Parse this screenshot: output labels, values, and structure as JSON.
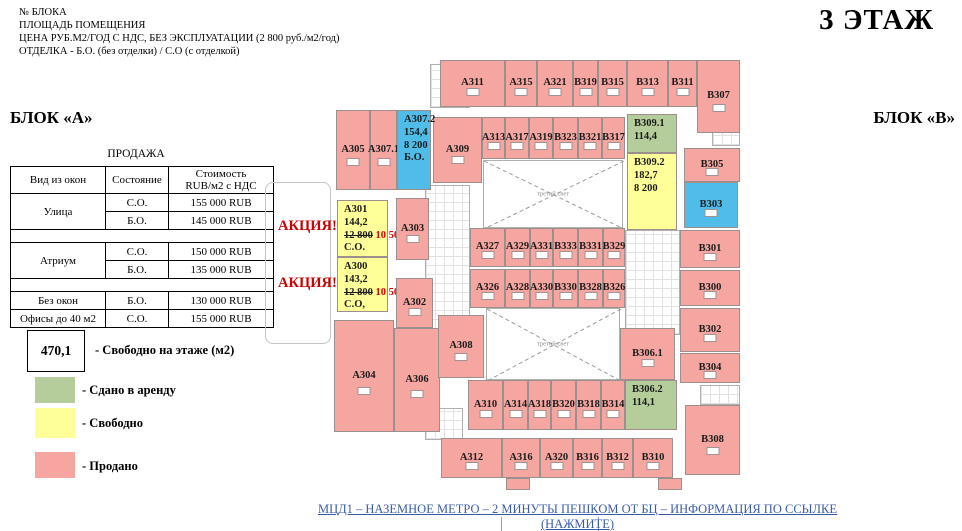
{
  "header": {
    "info_lines": [
      "№ БЛОКА",
      "ПЛОЩАДЬ ПОМЕЩЕНИЯ",
      "ЦЕНА РУБ.М2/ГОД С НДС, БЕЗ ЭКСПЛУАТАЦИИ (2 800 руб./м2/год)",
      "ОТДЕЛКА - Б.О. (без отделки) / С.О (с отделкой)"
    ],
    "floor_title": "3 ЭТАЖ",
    "block_a": "БЛОК «А»",
    "block_b": "БЛОК «В»"
  },
  "sales_table": {
    "title": "ПРОДАЖА",
    "col_view": "Вид из окон",
    "col_state": "Состояние",
    "col_price_1": "Стоимость",
    "col_price_2": "RUB/м2 с НДС",
    "street": "Улица",
    "atrium": "Атриум",
    "no_windows": "Без окон",
    "small_offices": "Офисы до 40 м2",
    "so": "С.О.",
    "bo": "Б.О.",
    "street_so_price": "155 000 RUB",
    "street_bo_price": "145 000 RUB",
    "atrium_so_price": "150 000 RUB",
    "atrium_bo_price": "135 000 RUB",
    "no_windows_price": "130 000 RUB",
    "small_offices_price": "155 000 RUB"
  },
  "legend": {
    "free_area_value": "470,1",
    "free_area_label": "- Свободно на этаже (м2)",
    "leased_label": "- Сдано в аренду",
    "free_label": "- Свободно",
    "sold_label": "- Продано"
  },
  "promo": {
    "label": "АКЦИЯ!"
  },
  "footer": {
    "link_text": "МЦД1 – НАЗЕМНОЕ МЕТРО – 2 МИНУТЫ ПЕШКОМ ОТ БЦ – ИНФОРМАЦИЯ ПО ССЫЛКЕ (НАЖМИТЕ)"
  },
  "floorplan": {
    "atrium_label": "третий свет",
    "status_colors": {
      "sold": "#f5a6a1",
      "leased": "#b5cd9b",
      "free": "#ffff99",
      "highlight": "#4fbde8",
      "promo_text": "#ce0000",
      "link": "#3a5ca8"
    },
    "rooms": [
      {
        "id": "А311",
        "s": "sold",
        "x": 440,
        "y": 60,
        "w": 65,
        "h": 47
      },
      {
        "id": "А315",
        "s": "sold",
        "x": 505,
        "y": 60,
        "w": 32,
        "h": 47
      },
      {
        "id": "А321",
        "s": "sold",
        "x": 537,
        "y": 60,
        "w": 36,
        "h": 47
      },
      {
        "id": "В319",
        "s": "sold",
        "x": 573,
        "y": 60,
        "w": 25,
        "h": 47
      },
      {
        "id": "В315",
        "s": "sold",
        "x": 598,
        "y": 60,
        "w": 29,
        "h": 47
      },
      {
        "id": "В313",
        "s": "sold",
        "x": 627,
        "y": 60,
        "w": 41,
        "h": 47
      },
      {
        "id": "В311",
        "s": "sold",
        "x": 668,
        "y": 60,
        "w": 29,
        "h": 47
      },
      {
        "id": "В307",
        "s": "sold",
        "x": 697,
        "y": 60,
        "w": 43,
        "h": 73
      },
      {
        "id": "А309",
        "s": "sold",
        "x": 433,
        "y": 117,
        "w": 49,
        "h": 66
      },
      {
        "id": "А313",
        "s": "sold",
        "x": 482,
        "y": 117,
        "w": 23,
        "h": 42
      },
      {
        "id": "А317",
        "s": "sold",
        "x": 505,
        "y": 117,
        "w": 24,
        "h": 42
      },
      {
        "id": "А319",
        "s": "sold",
        "x": 529,
        "y": 117,
        "w": 24,
        "h": 42
      },
      {
        "id": "В323",
        "s": "sold",
        "x": 553,
        "y": 117,
        "w": 25,
        "h": 42
      },
      {
        "id": "В321",
        "s": "sold",
        "x": 578,
        "y": 117,
        "w": 24,
        "h": 42
      },
      {
        "id": "В317",
        "s": "sold",
        "x": 602,
        "y": 117,
        "w": 23,
        "h": 42
      },
      {
        "id": "В309.1",
        "s": "leased",
        "x": 627,
        "y": 114,
        "w": 50,
        "h": 39,
        "area": "114,4"
      },
      {
        "id": "В309.2",
        "s": "free",
        "x": 627,
        "y": 153,
        "w": 50,
        "h": 77,
        "area": "182,7",
        "price": "8 200"
      },
      {
        "id": "А305",
        "s": "sold",
        "x": 336,
        "y": 110,
        "w": 34,
        "h": 80
      },
      {
        "id": "А307.1",
        "s": "sold",
        "x": 370,
        "y": 110,
        "w": 27,
        "h": 80
      },
      {
        "id": "А307.2",
        "s": "highlight",
        "x": 397,
        "y": 110,
        "w": 34,
        "h": 80,
        "area": "154,4",
        "price": "8 200",
        "finish": "Б.О."
      },
      {
        "id": "А301",
        "s": "free",
        "x": 337,
        "y": 200,
        "w": 51,
        "h": 57,
        "area": "144,2",
        "strike": "12 800",
        "promo": "10 500",
        "finish": "С.О."
      },
      {
        "id": "А300",
        "s": "free",
        "x": 337,
        "y": 257,
        "w": 51,
        "h": 55,
        "area": "143,2",
        "strike": "12 800",
        "promo": "10 500",
        "finish": "С.О,"
      },
      {
        "id": "А303",
        "s": "sold",
        "x": 396,
        "y": 198,
        "w": 33,
        "h": 62
      },
      {
        "id": "А302",
        "s": "sold",
        "x": 396,
        "y": 278,
        "w": 37,
        "h": 50
      },
      {
        "id": "А304",
        "s": "sold",
        "x": 334,
        "y": 320,
        "w": 60,
        "h": 112
      },
      {
        "id": "А306",
        "s": "sold",
        "x": 394,
        "y": 328,
        "w": 46,
        "h": 104
      },
      {
        "id": "А308",
        "s": "sold",
        "x": 438,
        "y": 315,
        "w": 46,
        "h": 63
      },
      {
        "id": "А327",
        "s": "sold",
        "x": 470,
        "y": 228,
        "w": 35,
        "h": 39
      },
      {
        "id": "А329",
        "s": "sold",
        "x": 505,
        "y": 228,
        "w": 25,
        "h": 39
      },
      {
        "id": "А331",
        "s": "sold",
        "x": 530,
        "y": 228,
        "w": 23,
        "h": 39
      },
      {
        "id": "В333",
        "s": "sold",
        "x": 553,
        "y": 228,
        "w": 25,
        "h": 39
      },
      {
        "id": "В331",
        "s": "sold",
        "x": 578,
        "y": 228,
        "w": 25,
        "h": 39
      },
      {
        "id": "В329",
        "s": "sold",
        "x": 603,
        "y": 228,
        "w": 22,
        "h": 39
      },
      {
        "id": "А326",
        "s": "sold",
        "x": 470,
        "y": 269,
        "w": 35,
        "h": 39
      },
      {
        "id": "А328",
        "s": "sold",
        "x": 505,
        "y": 269,
        "w": 25,
        "h": 39
      },
      {
        "id": "А330",
        "s": "sold",
        "x": 530,
        "y": 269,
        "w": 23,
        "h": 39
      },
      {
        "id": "В330",
        "s": "sold",
        "x": 553,
        "y": 269,
        "w": 25,
        "h": 39
      },
      {
        "id": "В328",
        "s": "sold",
        "x": 578,
        "y": 269,
        "w": 25,
        "h": 39
      },
      {
        "id": "В326",
        "s": "sold",
        "x": 603,
        "y": 269,
        "w": 22,
        "h": 39
      },
      {
        "id": "А310",
        "s": "sold",
        "x": 468,
        "y": 380,
        "w": 35,
        "h": 50
      },
      {
        "id": "А314",
        "s": "sold",
        "x": 503,
        "y": 380,
        "w": 25,
        "h": 50
      },
      {
        "id": "А318",
        "s": "sold",
        "x": 528,
        "y": 380,
        "w": 23,
        "h": 50
      },
      {
        "id": "В320",
        "s": "sold",
        "x": 551,
        "y": 380,
        "w": 25,
        "h": 50
      },
      {
        "id": "В318",
        "s": "sold",
        "x": 576,
        "y": 380,
        "w": 25,
        "h": 50
      },
      {
        "id": "В314",
        "s": "sold",
        "x": 601,
        "y": 380,
        "w": 24,
        "h": 50
      },
      {
        "id": "В306.1",
        "s": "sold",
        "x": 620,
        "y": 328,
        "w": 55,
        "h": 52
      },
      {
        "id": "В306.2",
        "s": "leased",
        "x": 625,
        "y": 380,
        "w": 52,
        "h": 50,
        "area": "114,1"
      },
      {
        "id": "В305",
        "s": "sold",
        "x": 684,
        "y": 148,
        "w": 56,
        "h": 34
      },
      {
        "id": "В303",
        "s": "highlight",
        "x": 684,
        "y": 182,
        "w": 54,
        "h": 46
      },
      {
        "id": "В301",
        "s": "sold",
        "x": 680,
        "y": 230,
        "w": 60,
        "h": 38
      },
      {
        "id": "В300",
        "s": "sold",
        "x": 680,
        "y": 270,
        "w": 60,
        "h": 36
      },
      {
        "id": "В302",
        "s": "sold",
        "x": 680,
        "y": 308,
        "w": 60,
        "h": 44
      },
      {
        "id": "В304",
        "s": "sold",
        "x": 680,
        "y": 353,
        "w": 60,
        "h": 30
      },
      {
        "id": "В308",
        "s": "sold",
        "x": 685,
        "y": 405,
        "w": 55,
        "h": 70
      },
      {
        "id": "А312",
        "s": "sold",
        "x": 441,
        "y": 438,
        "w": 61,
        "h": 40
      },
      {
        "id": "А316",
        "s": "sold",
        "x": 502,
        "y": 438,
        "w": 38,
        "h": 40
      },
      {
        "id": "А320",
        "s": "sold",
        "x": 540,
        "y": 438,
        "w": 33,
        "h": 40
      },
      {
        "id": "В316",
        "s": "sold",
        "x": 573,
        "y": 438,
        "w": 29,
        "h": 40
      },
      {
        "id": "В312",
        "s": "sold",
        "x": 602,
        "y": 438,
        "w": 31,
        "h": 40
      },
      {
        "id": "В310",
        "s": "sold",
        "x": 633,
        "y": 438,
        "w": 40,
        "h": 40
      },
      {
        "s": "sold",
        "x": 506,
        "y": 478,
        "w": 24,
        "h": 12
      },
      {
        "s": "sold",
        "x": 658,
        "y": 478,
        "w": 24,
        "h": 12
      }
    ],
    "structures": [
      {
        "t": "stair",
        "x": 430,
        "y": 64,
        "w": 40,
        "h": 44
      },
      {
        "t": "core",
        "x": 425,
        "y": 185,
        "w": 45,
        "h": 145
      },
      {
        "t": "core",
        "x": 625,
        "y": 230,
        "w": 55,
        "h": 105
      },
      {
        "t": "stair",
        "x": 425,
        "y": 408,
        "w": 38,
        "h": 32
      },
      {
        "t": "stair",
        "x": 712,
        "y": 128,
        "w": 28,
        "h": 18
      },
      {
        "t": "stair",
        "x": 700,
        "y": 385,
        "w": 40,
        "h": 20
      },
      {
        "t": "atrium",
        "x": 483,
        "y": 160,
        "w": 140,
        "h": 68
      },
      {
        "t": "atrium",
        "x": 486,
        "y": 308,
        "w": 134,
        "h": 72
      },
      {
        "t": "box",
        "x": 265,
        "y": 182,
        "w": 66,
        "h": 162
      },
      {
        "t": "mark",
        "x": 501,
        "y": 517,
        "w": 1,
        "h": 14
      },
      {
        "t": "mark",
        "x": 598,
        "y": 517,
        "w": 1,
        "h": 14
      }
    ]
  }
}
